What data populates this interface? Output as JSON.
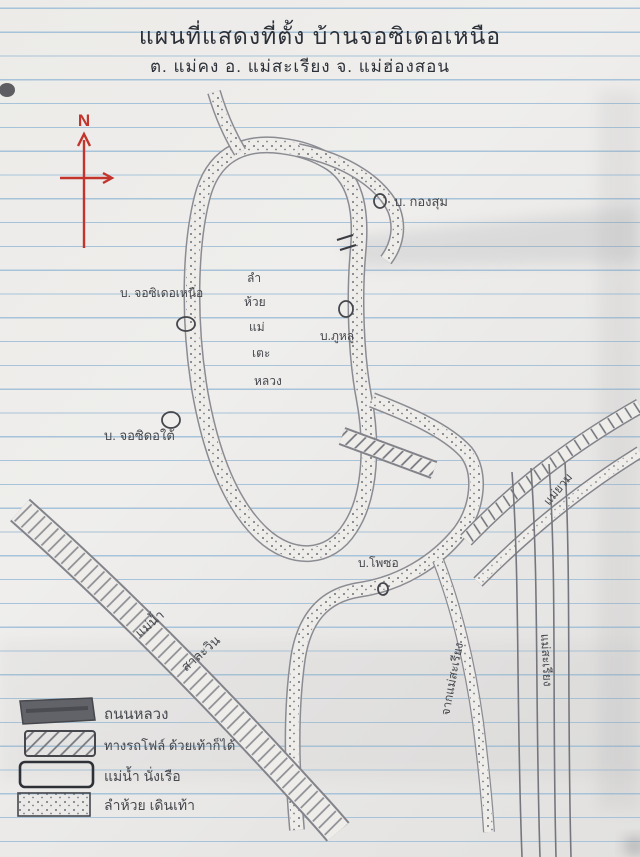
{
  "page": {
    "title_line1": "แผนที่แสดงที่ตั้ง บ้านจอซิเดอเหนือ",
    "title_line2": "ต. แม่คง    อ. แม่สะเรียง    จ. แม่ฮ่องสอน"
  },
  "compass": {
    "label": "N"
  },
  "map_labels": {
    "kong_sum": "บ. กองสุม",
    "jo_si_doe_nuea": "บ. จอซิเดอเหนือ",
    "phu_lu": "บ.ภูหลู่",
    "jo_si_do_tai": "บ. จอซิดอใต้",
    "pho_so": "บ.โพซอ",
    "stream_stack": [
      "ลำ",
      "ห้วย",
      "แม่",
      "เตะ",
      "หลวง"
    ],
    "salween_1": "แม่น้ำ",
    "salween_2": "สาละวิน",
    "mae_yuam": "แม่ยวม",
    "from_mae_sariang": "จากแม่สะเรียง",
    "mae_sariang": "แม่สะเรียง"
  },
  "legend": {
    "items": [
      {
        "label": "ถนนหลวง",
        "swatch": "solid"
      },
      {
        "label": "ทางรถโฟล์ ด้วยเท้าก็ได้",
        "swatch": "hatched"
      },
      {
        "label": "แม่น้ำ นั่งเรือ",
        "swatch": "outline"
      },
      {
        "label": "ลำห้วย เดินเท้า",
        "swatch": "dotted"
      }
    ]
  },
  "colors": {
    "paper": "#ecebe8",
    "ruled_line_blue": "#a7c3d9",
    "pencil_gray": "#85868d",
    "ink_dark": "#2c3038",
    "compass_red": "#c2342c"
  }
}
